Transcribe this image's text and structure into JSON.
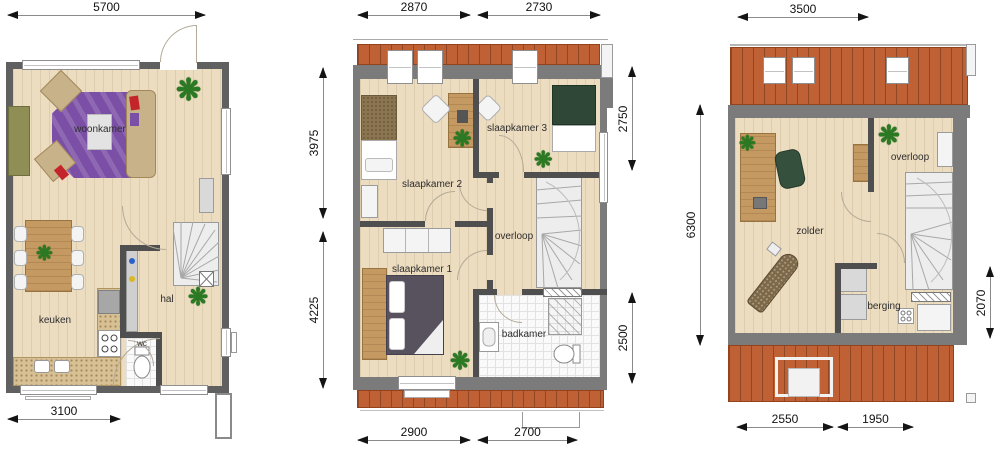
{
  "colors": {
    "wall": "#666666",
    "interior_wall": "#4f4f4f",
    "roof_tile": "#bf6134",
    "floor_wood": "#ecdcc0",
    "rug_purple": "#7b4fa5",
    "sofa_tan": "#c8b289",
    "bed_green": "#2e4736",
    "bed_slate": "#57525e",
    "plant_green": "#2b7a23"
  },
  "icons": {
    "plant": "❋"
  },
  "plans": {
    "ground": {
      "rooms": {
        "living": "woonkamer",
        "kitchen": "keuken",
        "hall": "hal",
        "toilet": "wc"
      },
      "dims": {
        "width_top": "5700",
        "width_bottom": "3100"
      }
    },
    "first": {
      "rooms": {
        "bedroom1": "slaapkamer 1",
        "bedroom2": "slaapkamer 2",
        "bedroom3": "slaapkamer 3",
        "landing": "overloop",
        "bathroom": "badkamer"
      },
      "dims": {
        "top_left": "2870",
        "top_right": "2730",
        "left_upper": "3975",
        "left_lower": "4225",
        "right_upper": "2750",
        "right_lower": "2500",
        "bottom_left": "2900",
        "bottom_right": "2700"
      }
    },
    "attic": {
      "rooms": {
        "attic": "zolder",
        "landing": "overloop",
        "storage": "berging"
      },
      "dims": {
        "width_top": "3500",
        "height_left": "6300",
        "height_right": "2070",
        "bottom_left": "2550",
        "bottom_right": "1950"
      }
    }
  }
}
